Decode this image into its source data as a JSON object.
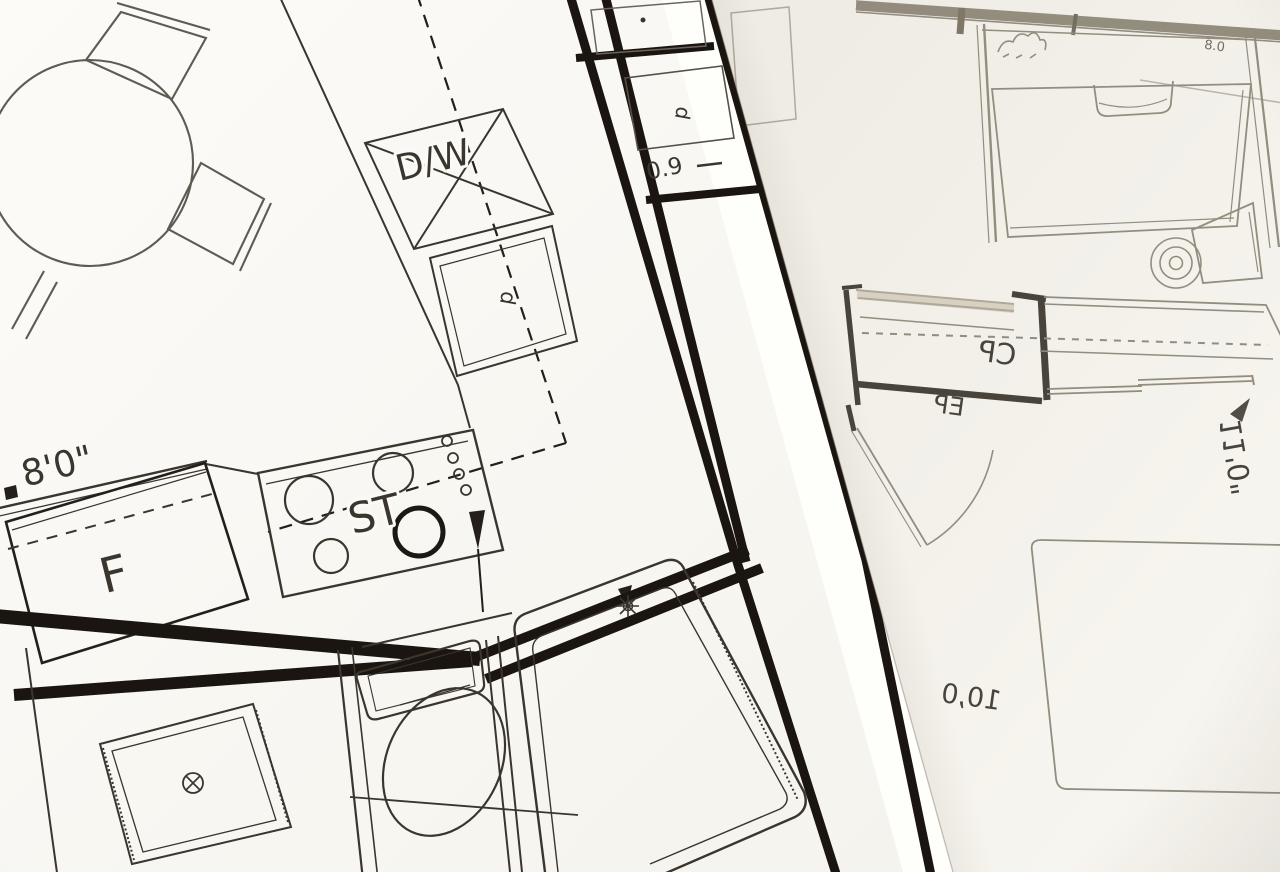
{
  "scene": {
    "description": "Photograph of two overlapping architectural floor plan sheets",
    "left_sheet": {
      "labels": {
        "dishwasher": "D/W",
        "stove": "ST",
        "fridge": "F",
        "door": "d",
        "width_dim": "8'0\"",
        "small_dim": "0.9"
      }
    },
    "right_sheet": {
      "labels": {
        "closet_cp": "CP",
        "closet_ep": "EP",
        "height_dim": "11'0\"",
        "width_dim": "10,0",
        "small_dim": "0.8"
      }
    },
    "colors": {
      "left_paper": "#fbfaf6",
      "right_paper": "#f2f0e9",
      "ink_dark": "#1a1510",
      "ink_medium": "#3a352d",
      "pencil_gray": "#5f5a52",
      "right_ink": "#8e8779",
      "right_ink_dark": "#3f3a32",
      "shadow": "#70624e"
    }
  }
}
